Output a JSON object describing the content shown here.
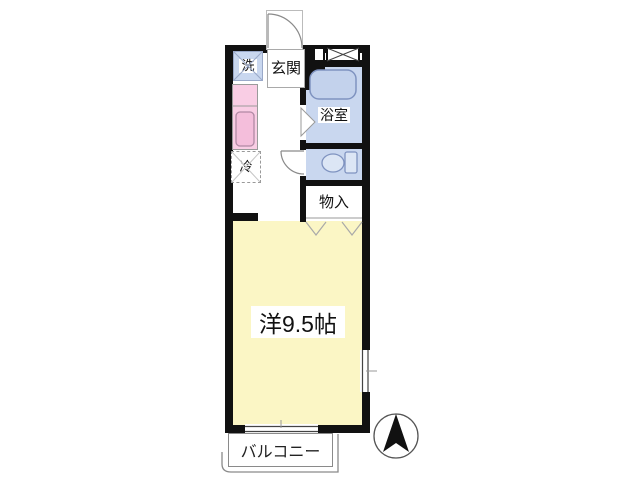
{
  "floorplan": {
    "labels": {
      "washer": "洗",
      "entrance": "玄関",
      "bathroom": "浴室",
      "refrigerator": "冷",
      "storage": "物入",
      "main_room": "洋9.5帖",
      "balcony": "バルコニー"
    },
    "main_room_size_jo": 9.5,
    "compass": {
      "direction": "north-up"
    },
    "colors": {
      "wall": "#111111",
      "wet_area": "#c9d7ef",
      "kitchen": "#f9cde4",
      "main_room": "#fbf6c5",
      "fixture_stroke": "#7f93c0",
      "outline_gray": "#8a8a8a"
    }
  }
}
